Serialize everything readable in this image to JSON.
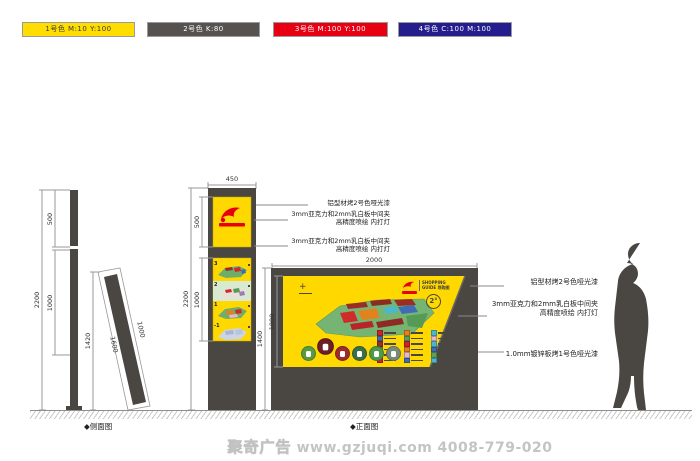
{
  "colors": {
    "yellow": "#FFD800",
    "dark": "#4A4642",
    "red": "#E60012",
    "blue": "#241D8E",
    "light_green_strip": "#D9EAD3"
  },
  "swatches": [
    {
      "label": "1号色 M:10 Y:100",
      "color": "#FFDD00",
      "text_color": "#3a3a3a"
    },
    {
      "label": "2号色 K:80",
      "color": "#565250",
      "text_color": "#ffffff"
    },
    {
      "label": "3号色 M:100 Y:100",
      "color": "#E60012",
      "text_color": "#ffffff"
    },
    {
      "label": "4号色 C:100 M:100",
      "color": "#241D8E",
      "text_color": "#ffffff"
    }
  ],
  "side_view": {
    "label": "◆侧面图",
    "pole_total": "2200",
    "pole_upper": "500",
    "pole_panel": "1000",
    "tilt_height": "1420",
    "tilt_slant": "1600",
    "tilt_panel": "1000"
  },
  "totem": {
    "width": "450",
    "total": "2200",
    "logo_panel": "500",
    "map_panel": "1000",
    "floors": [
      "3",
      "2",
      "1",
      "-1"
    ]
  },
  "totem_annotations": [
    {
      "l1": "铝型材烤2号色哑光漆",
      "l2": ""
    },
    {
      "l1": "3mm亚克力和2mm乳白板中间夹",
      "l2": "高精度喷绘  内打灯"
    },
    {
      "l1": "3mm亚克力和2mm乳白板中间夹",
      "l2": "高精度喷绘  内打灯"
    }
  ],
  "front_view": {
    "label": "◆正面图",
    "width": "2000",
    "total_height": "1400",
    "panel_height": "1000",
    "compass": "+",
    "logo": {
      "line1": "SHOPPING",
      "line2": "GUIDE 导购图",
      "badge": "2°"
    },
    "legend_colors": [
      "#c9252c",
      "#e2821c",
      "#49b8d0",
      "#3f6db3",
      "#5da05d",
      "#e8b7c9",
      "#9b2d26",
      "#c9252c",
      "#49b8d0",
      "#5da05d",
      "#e2821c",
      "#3f6db3",
      "#8e2a24",
      "#e8b7c9",
      "#5da05d",
      "#c9252c",
      "#3f6db3",
      "#49b8d0"
    ],
    "amenity_colors": [
      "#5a9a3f",
      "#6e1f24",
      "#9e2a2e",
      "#3c6e46",
      "#4f9a44",
      "#7a8a78"
    ]
  },
  "front_annotations": [
    {
      "l1": "铝型材烤2号色哑光漆",
      "l2": ""
    },
    {
      "l1": "3mm亚克力和2mm乳白板中间夹",
      "l2": "高精度喷绘  内打灯"
    },
    {
      "l1": "1.0mm镀锌板烤1号色哑光漆",
      "l2": ""
    }
  ],
  "footer": {
    "brand": "聚奇广告",
    "url": "www.gzjuqi.com",
    "phone": "4008-779-020"
  }
}
